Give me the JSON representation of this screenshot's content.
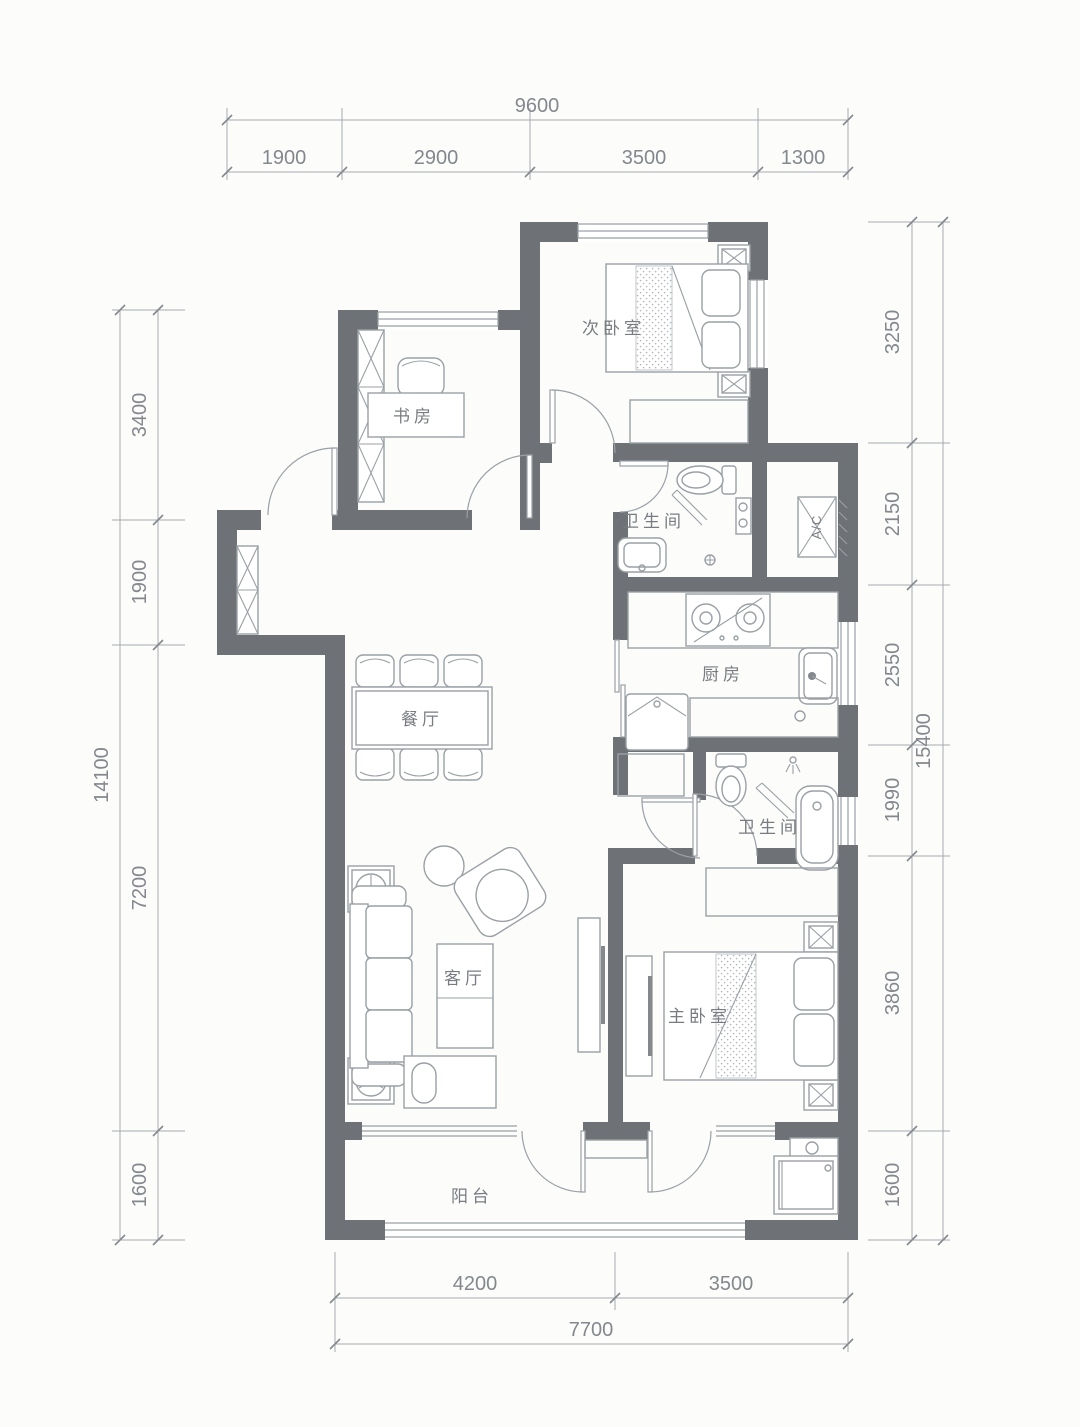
{
  "title": "apartment-floor-plan",
  "colors": {
    "wall": "#6e7175",
    "line": "#9aa0a5",
    "dim": "#a6aaae",
    "text": "#787c81",
    "dimtext": "#84888d",
    "bg": "#fcfcfb"
  },
  "rooms": {
    "secondary_bedroom": "次卧室",
    "study": "书房",
    "bathroom_upper": "卫生间",
    "bathroom_lower": "卫生间",
    "kitchen": "厨房",
    "dining": "餐厅",
    "living": "客厅",
    "master_bedroom": "主卧室",
    "balcony": "阳台",
    "ac_unit": "A/C"
  },
  "dims": {
    "top": {
      "total": "9600",
      "segments": [
        "1900",
        "2900",
        "3500",
        "1300"
      ]
    },
    "left": {
      "total": "14100",
      "segments": [
        "3400",
        "1900",
        "7200",
        "1600"
      ]
    },
    "right": {
      "total": "15400",
      "segments": [
        "3250",
        "2150",
        "2550",
        "1990",
        "3860",
        "1600"
      ]
    },
    "bottom": {
      "total": "7700",
      "segments": [
        "4200",
        "3500"
      ]
    }
  }
}
